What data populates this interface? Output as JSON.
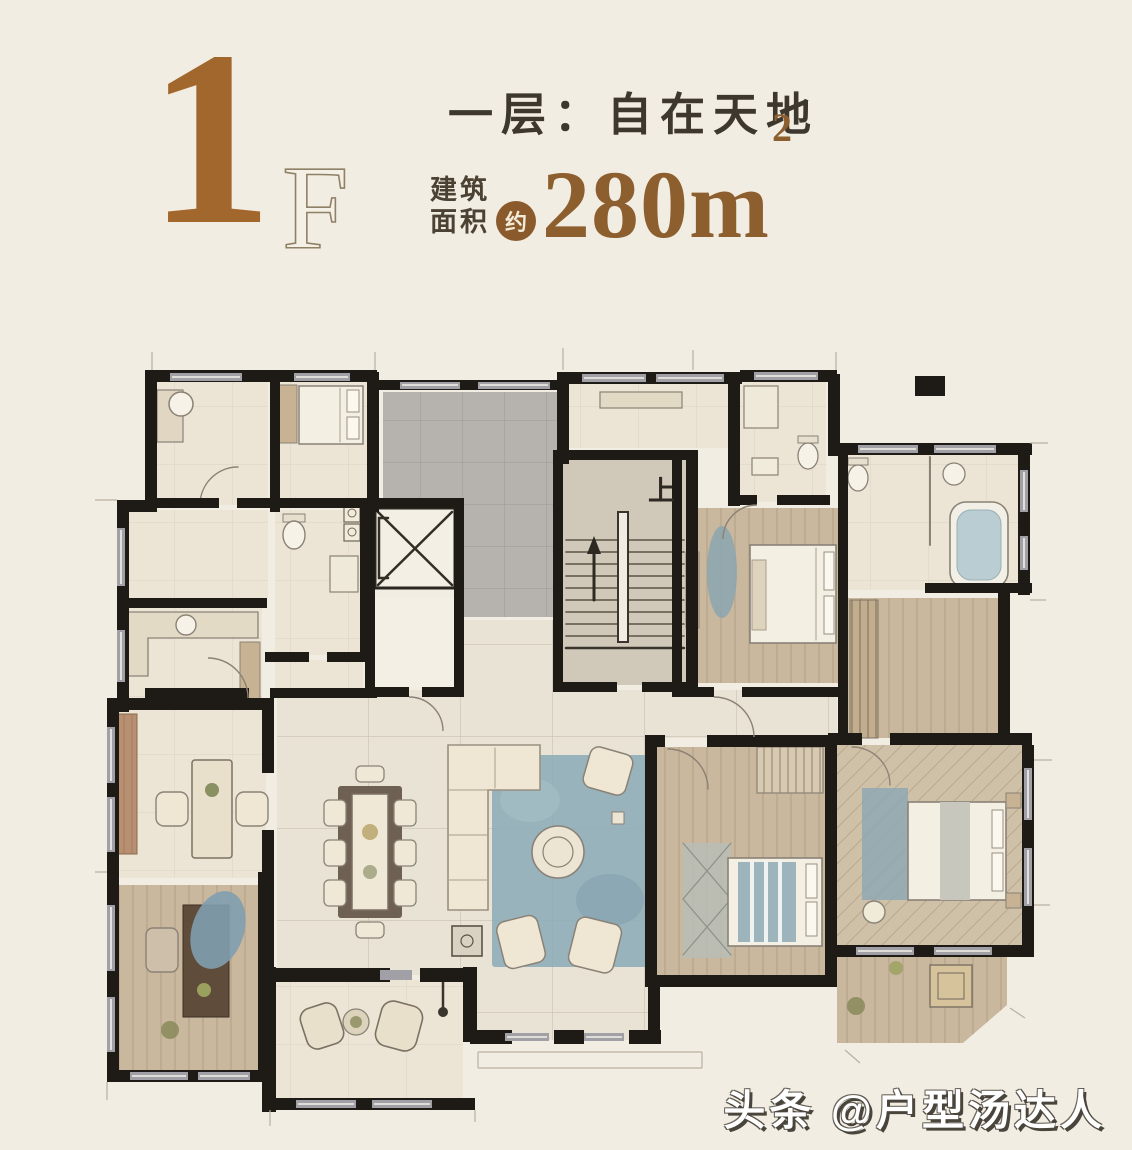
{
  "page": {
    "background": "#f2ede2"
  },
  "header": {
    "floor_number": "1",
    "floor_suffix": "F",
    "title": "一层：自在天地",
    "area_label_top": "建筑",
    "area_label_bottom": "面积",
    "area_qualifier": "约",
    "area_value": "280m",
    "area_sup": "2"
  },
  "plan": {
    "stairs_up_label": "上",
    "colors": {
      "wall": "#1e1a15",
      "window": "#a0a0a6",
      "room_beige": "#ece4d4",
      "marble_floor": "#e9e3d5",
      "terrace_gray": "#b6b3ae",
      "wood": "#c9b79e",
      "herringbone": "#cfc0a8",
      "rug_blue": "#8fadb9",
      "stair_fill": "#d0c9ba",
      "furniture_cream": "#efe7d4",
      "furniture_tan": "#c8b294",
      "accent_brown": "#a2672d"
    },
    "rooms": [
      "bathroom-nw",
      "maid-room",
      "laundry",
      "kitchen",
      "terrace",
      "elevator",
      "elevator-lobby",
      "stair-hall",
      "entry-hall",
      "bathroom-north",
      "bedroom-north",
      "bathroom-east",
      "hall-east",
      "study",
      "tea-room",
      "dining-room",
      "living-room",
      "porch",
      "bedroom-south",
      "bedroom-master",
      "balcony-southeast"
    ]
  },
  "watermark": {
    "text": "头条 @户型汤达人"
  }
}
